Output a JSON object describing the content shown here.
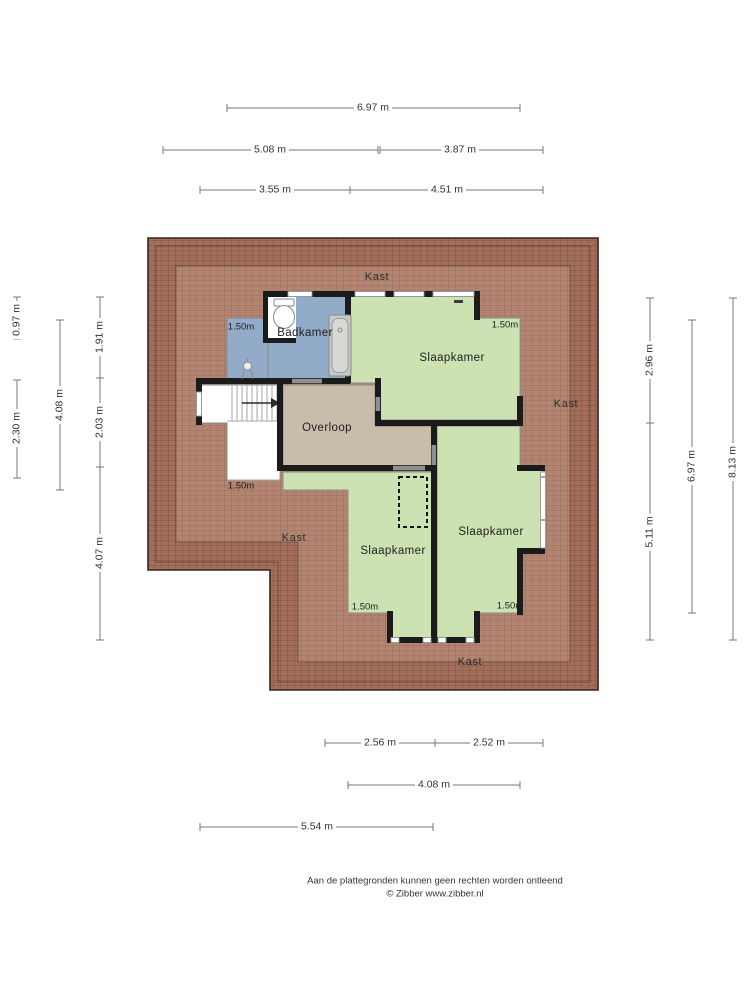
{
  "dimensions": {
    "top": [
      "6.97 m",
      "5.08 m",
      "3.87 m",
      "3.55 m",
      "4.51 m"
    ],
    "left": [
      "0.97 m",
      "2.30 m",
      "4.08 m",
      "1.91 m",
      "2.03 m",
      "4.07 m"
    ],
    "right": [
      "2.96 m",
      "5.11 m",
      "6.97 m",
      "8.13 m"
    ],
    "bottom": [
      "2.56 m",
      "2.52 m",
      "4.08 m",
      "5.54 m"
    ]
  },
  "rooms": {
    "badkamer": "Badkamer",
    "slaapkamer_top": "Slaapkamer",
    "slaapkamer_bottom_left": "Slaapkamer",
    "slaapkamer_bottom_right": "Slaapkamer",
    "overloop": "Overloop",
    "kast_top": "Kast",
    "kast_right": "Kast",
    "kast_left": "Kast",
    "kast_bottom": "Kast"
  },
  "height_markers": {
    "badkamer": "1.50m",
    "slaapkamer_top": "1.50m",
    "stairs": "1.50m",
    "slaapkamer_bottom_left": "1.50m",
    "slaapkamer_bottom_right": "1.50m"
  },
  "footer": {
    "disclaimer": "Aan de plattegronden kunnen geen rechten worden ontleend",
    "copyright": "© Zibber www.zibber.nl"
  },
  "colors": {
    "roof_tile": "#a4705b",
    "roof_tile_line": "#6a4034",
    "roof_outline": "#3a241c",
    "room_green": "#cde2b2",
    "room_blue": "#92abc9",
    "room_beige": "#c8bcab",
    "wall": "#1b1b1b",
    "door_opening": "#8f8f8f",
    "dimension_line": "#777777"
  }
}
